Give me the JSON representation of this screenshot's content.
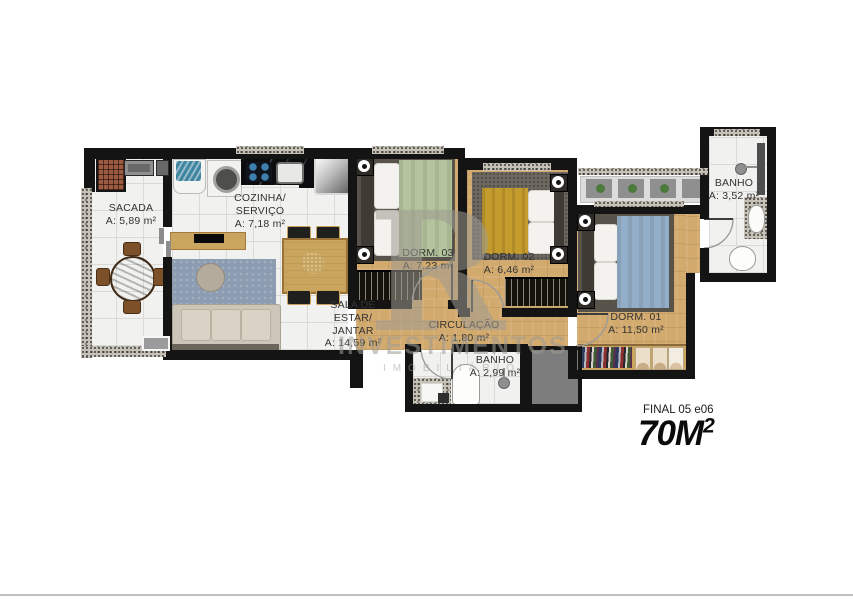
{
  "watermark": {
    "letter": "R",
    "line1": "INVESTIMENTOS",
    "line2": "IMOBILIÁRIO"
  },
  "rooms": {
    "sacada": {
      "name": "SACADA",
      "area": "A: 5,89 m²"
    },
    "cozinha": {
      "name1": "COZINHA/",
      "name2": "SERVIÇO",
      "area": "A: 7,18 m²"
    },
    "sala": {
      "name1": "SALA DE ESTAR/",
      "name2": "JANTAR",
      "area": "A: 14,59 m²"
    },
    "dorm3": {
      "name": "DORM. 03",
      "area": "A: 7,23 m²"
    },
    "dorm2": {
      "name": "DORM. 02",
      "area": "A: 6,46 m²"
    },
    "dorm1": {
      "name": "DORM. 01",
      "area": "A: 11,50 m²"
    },
    "circulacao": {
      "name": "CIRCULAÇÃO",
      "area": "A: 1,80 m²"
    },
    "banho_social": {
      "name": "BANHO",
      "area": "A: 2,99 m²"
    },
    "banho_suite": {
      "name": "BANHO",
      "area": "A: 3,52 m²"
    }
  },
  "footer": {
    "final_label": "FINAL 05 e06",
    "area_value": "70M",
    "area_sup": "2"
  },
  "colors": {
    "wall": "#141414",
    "wood": "#d3aa6e",
    "wood_dark": "#c59a5c",
    "tile": "#f1f1ef",
    "tile_line": "#dadad6",
    "granite": "#c7c2b8",
    "bed_green": "#b4c49d",
    "bed_yellow": "#c49b2d",
    "bed_blue": "#93aec8",
    "carpet": "#6e6960",
    "rug": "#8c9cb1",
    "sofa": "#cdc6b8",
    "furniture_wood": "#c9a55e",
    "chair_dark": "#1f1f1e",
    "label": "#333333",
    "watermark": "rgba(158,154,146,0.55)"
  }
}
